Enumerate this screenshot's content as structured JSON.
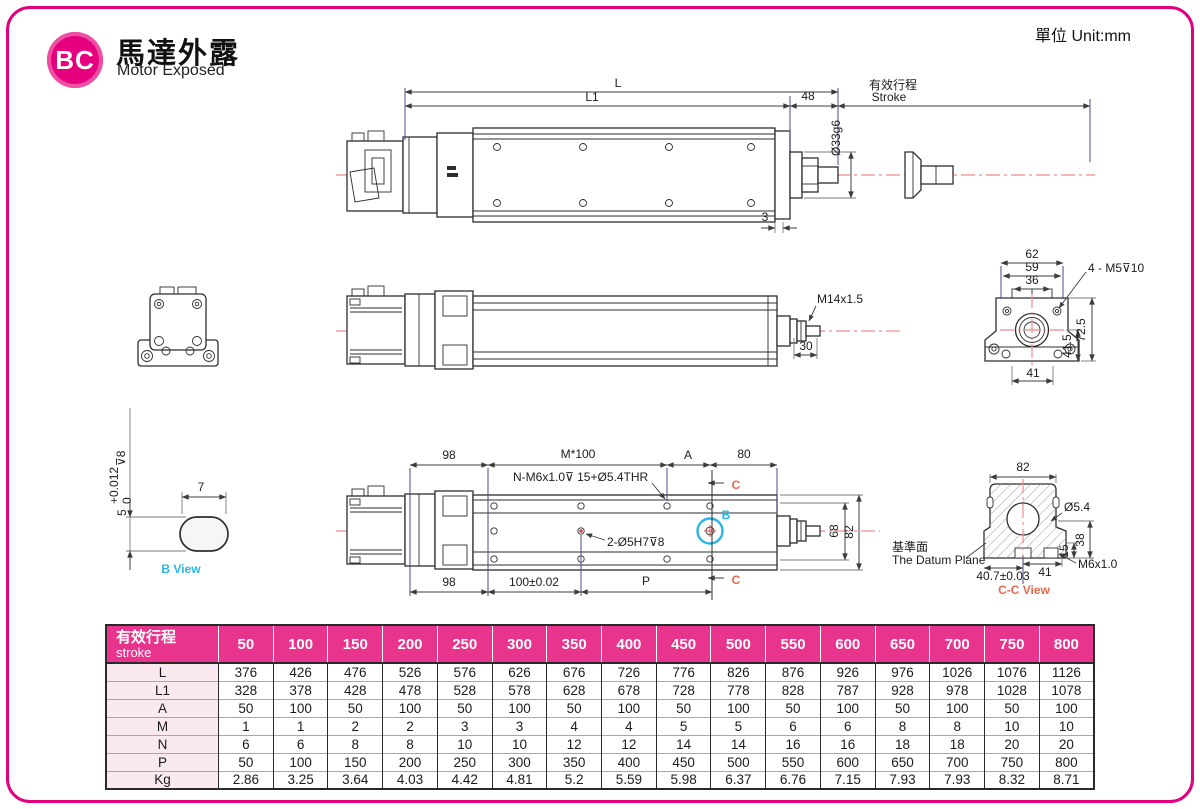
{
  "page": {
    "unit_label": "單位 Unit:mm"
  },
  "logo": {
    "badge": "BC",
    "title": "馬達外露",
    "subtitle": "Motor Exposed"
  },
  "colors": {
    "magenta": "#E2007F",
    "table_header": "#E8348C",
    "cyan": "#29B6E6",
    "section_orange": "#E4694D",
    "centerline_red": "#F28B8B",
    "witness_navy": "#4A4A8F"
  },
  "views": {
    "top": {
      "dim_L": "L",
      "dim_L1": "L1",
      "dim_48": "48",
      "dim_3": "3",
      "stroke_zh": "有效行程",
      "stroke_en": "Stroke",
      "dim_dia": "Ø33g6"
    },
    "middle": {
      "thread": "M14x1.5",
      "dim_30": "30"
    },
    "rear": {
      "dim_62": "62",
      "dim_59": "59",
      "dim_36": "36",
      "holes": "4 - M5⊽10",
      "dim_41_5": "41.5",
      "dim_72_5": "72.5",
      "dim_41": "41"
    },
    "b_view": {
      "dim_7": "7",
      "dim_5": "5",
      "tol_hi": "+0.012",
      "tol_lo": "0",
      "depth": "⊽8",
      "label": "B View"
    },
    "bottom": {
      "dim_98_top": "98",
      "dim_M100": "M*100",
      "dim_A": "A",
      "dim_80": "80",
      "holes_top": "N-M6x1.0⊽ 15+Ø5.4THR",
      "holes_mid": "2-Ø5H7⊽8",
      "dim_68": "68",
      "dim_82": "82",
      "dim_98_bottom": "98",
      "dim_100": "100±0.02",
      "dim_P": "P",
      "label_B": "B",
      "label_C": "C"
    },
    "cc": {
      "dim_82": "82",
      "dim_d54": "Ø5.4",
      "dim_38": "38",
      "dim_15": "15",
      "thread": "M6x1.0",
      "dim_407": "40.7±0.03",
      "dim_41": "41",
      "datum_zh": "基準面",
      "datum_en": "The Datum Plane",
      "label": "C-C View"
    }
  },
  "table": {
    "header_zh": "有效行程",
    "header_en": "stroke",
    "strokes": [
      "50",
      "100",
      "150",
      "200",
      "250",
      "300",
      "350",
      "400",
      "450",
      "500",
      "550",
      "600",
      "650",
      "700",
      "750",
      "800"
    ],
    "rows": [
      {
        "label": "L",
        "values": [
          "376",
          "426",
          "476",
          "526",
          "576",
          "626",
          "676",
          "726",
          "776",
          "826",
          "876",
          "926",
          "976",
          "1026",
          "1076",
          "1126"
        ]
      },
      {
        "label": "L1",
        "values": [
          "328",
          "378",
          "428",
          "478",
          "528",
          "578",
          "628",
          "678",
          "728",
          "778",
          "828",
          "787",
          "928",
          "978",
          "1028",
          "1078"
        ]
      },
      {
        "label": "A",
        "values": [
          "50",
          "100",
          "50",
          "100",
          "50",
          "100",
          "50",
          "100",
          "50",
          "100",
          "50",
          "100",
          "50",
          "100",
          "50",
          "100"
        ]
      },
      {
        "label": "M",
        "values": [
          "1",
          "1",
          "2",
          "2",
          "3",
          "3",
          "4",
          "4",
          "5",
          "5",
          "6",
          "6",
          "8",
          "8",
          "10",
          "10"
        ]
      },
      {
        "label": "N",
        "values": [
          "6",
          "6",
          "8",
          "8",
          "10",
          "10",
          "12",
          "12",
          "14",
          "14",
          "16",
          "16",
          "18",
          "18",
          "20",
          "20"
        ]
      },
      {
        "label": "P",
        "values": [
          "50",
          "100",
          "150",
          "200",
          "250",
          "300",
          "350",
          "400",
          "450",
          "500",
          "550",
          "600",
          "650",
          "700",
          "750",
          "800"
        ]
      },
      {
        "label": "Kg",
        "values": [
          "2.86",
          "3.25",
          "3.64",
          "4.03",
          "4.42",
          "4.81",
          "5.2",
          "5.59",
          "5.98",
          "6.37",
          "6.76",
          "7.15",
          "7.93",
          "7.93",
          "8.32",
          "8.71"
        ]
      }
    ]
  }
}
